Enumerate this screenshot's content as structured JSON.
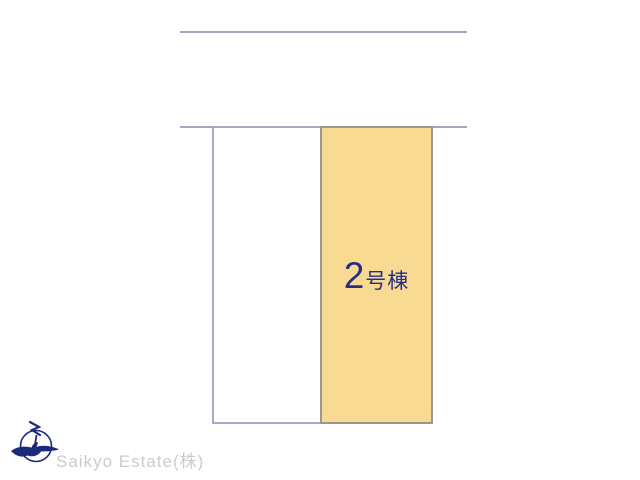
{
  "canvas": {
    "width": 640,
    "height": 480,
    "background": "#ffffff"
  },
  "site_plan": {
    "boundary_line_color": "#a2a6c2",
    "plots": [
      {
        "name": "plot-1",
        "label_number": "",
        "label_suffix": "",
        "fill": "#ffffff",
        "border": "#a9aac6"
      },
      {
        "name": "plot-2",
        "label_number": "2",
        "label_suffix": "号棟",
        "label_color": "#272e85",
        "fill": "#f9da92",
        "border": "#9d978b"
      }
    ]
  },
  "footer": {
    "logo": "swallow-bird-circle-logo",
    "logo_color": "#1b2a7b",
    "company_name": "Saikyo Estate(株)",
    "company_text_color": "#cbcbcb"
  }
}
